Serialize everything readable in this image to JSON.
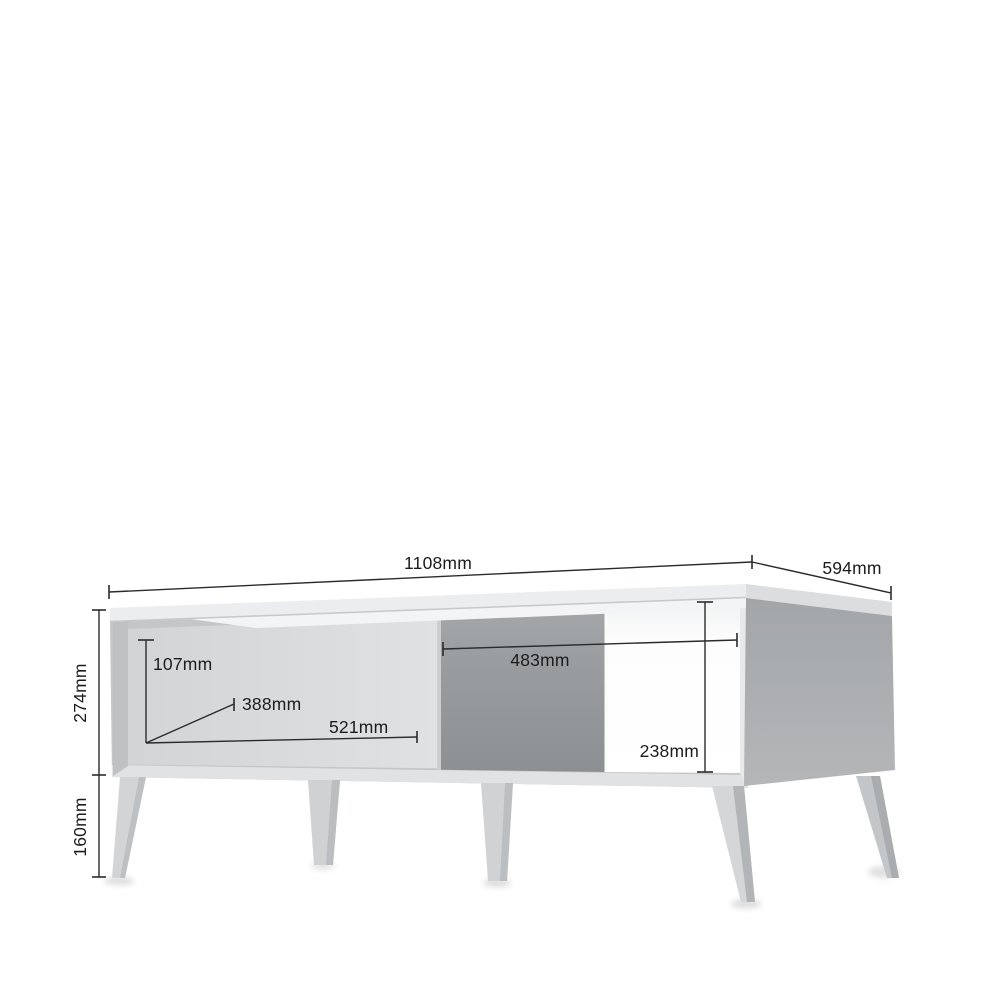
{
  "diagram": {
    "subject": "coffee-table-dimension-drawing",
    "unit": "mm",
    "dims": {
      "width": "1108mm",
      "depth": "594mm",
      "body_height": "274mm",
      "leg_height": "160mm",
      "front_panel_height": "107mm",
      "front_panel_diagonal": "388mm",
      "front_panel_width": "521mm",
      "shelf_opening_width": "483mm",
      "shelf_opening_height": "238mm"
    },
    "colors": {
      "background": "#ffffff",
      "dimension_line": "#2b2b2b",
      "label_text": "#1c1c1c",
      "tabletop": "#f3f4f5",
      "drawer_front": "#d8dadc",
      "side_panel": "#a8abae",
      "interior_back": "#95989b",
      "shelf_back_open": "#fdfdfd",
      "plinth": "#e0e2e3",
      "leg": "#d2d4d6"
    }
  }
}
